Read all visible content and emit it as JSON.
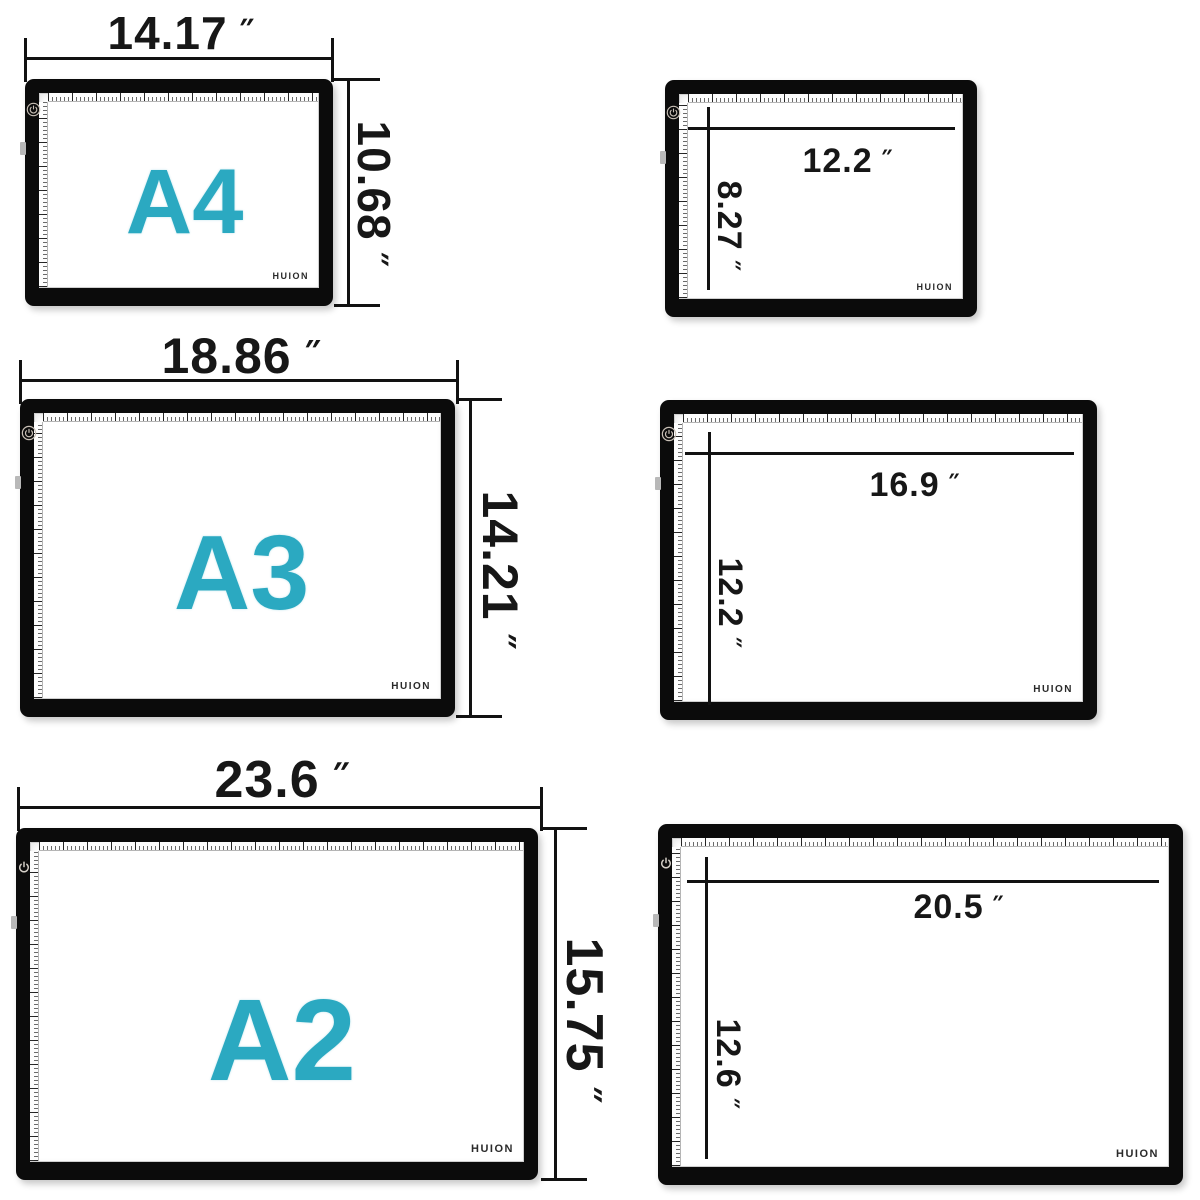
{
  "brand": "HUION",
  "unit_mark": "″",
  "colors": {
    "accent": "#2BA9C1",
    "frame": "#0B0B0B",
    "dimension_ink": "#121212"
  },
  "panels": [
    {
      "size_label": "A4",
      "width": "14.17",
      "height": "10.68"
    },
    {
      "width": "12.2",
      "height": "8.27"
    },
    {
      "size_label": "A3",
      "width": "18.86",
      "height": "14.21"
    },
    {
      "width": "16.9",
      "height": "12.2"
    },
    {
      "size_label": "A2",
      "width": "23.6",
      "height": "15.75"
    },
    {
      "width": "20.5",
      "height": "12.6"
    }
  ]
}
